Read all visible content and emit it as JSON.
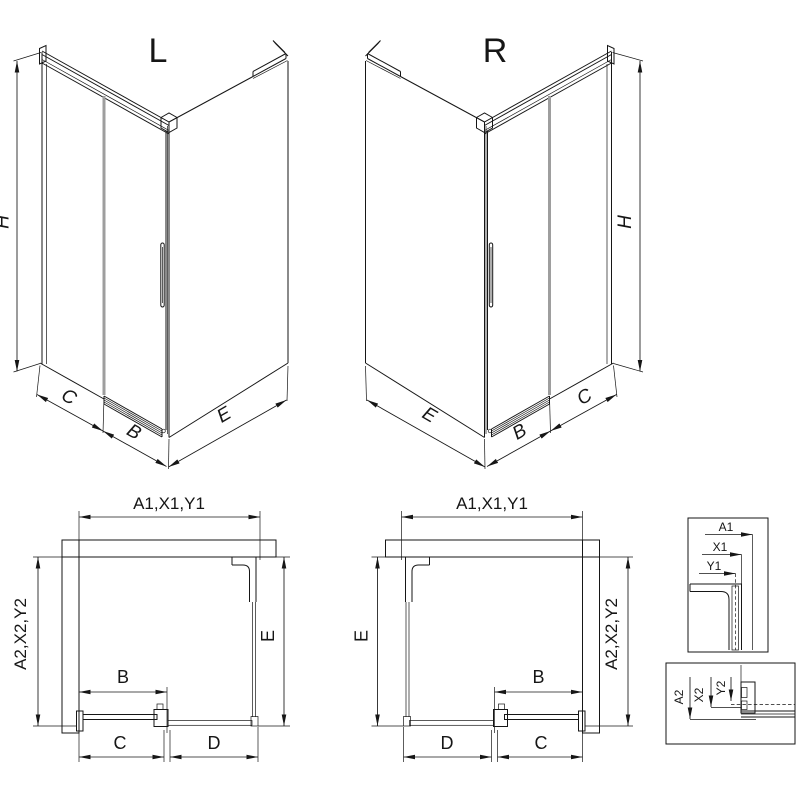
{
  "page": {
    "background": "#ffffff",
    "line_color": "#161616",
    "glass_edge_gray": "#9e9e9e"
  },
  "views": {
    "iso_left": {
      "title": "L"
    },
    "iso_right": {
      "title": "R"
    },
    "labels": {
      "height": "H",
      "fixed_panel": "C",
      "door": "B",
      "side_panel": "E",
      "fixed_bottom": "D",
      "width_dims": "A1,X1,Y1",
      "depth_dims": "A2,X2,Y2"
    },
    "detail_width": {
      "a1": "A1",
      "x1": "X1",
      "y1": "Y1"
    },
    "detail_depth": {
      "a2": "A2",
      "x2": "X2",
      "y2": "Y2"
    }
  }
}
